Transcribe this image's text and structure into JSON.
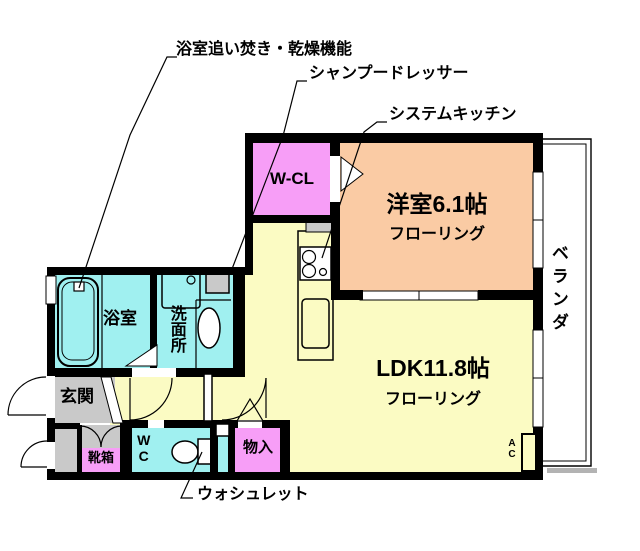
{
  "callouts": {
    "bath_reheat": "浴室追い焚き・乾燥機能",
    "shampoo_dresser": "シャンプードレッサー",
    "system_kitchen": "システムキッチン",
    "washlet": "ウォシュレット"
  },
  "rooms": {
    "walk_in_closet": "W-CL",
    "western_room": "洋室6.1帖",
    "western_room_floor": "フローリング",
    "ldk": "LDK11.8帖",
    "ldk_floor": "フローリング",
    "bathroom": "浴室",
    "washroom": "洗面所",
    "toilet": "WC",
    "storage": "物入",
    "shoe_box": "靴箱",
    "entrance": "玄関",
    "veranda": "ベランダ",
    "air_con": "AC"
  },
  "colors": {
    "wall": "#000000",
    "ldk_yellow": "#FBFBC3",
    "western_room_peach": "#FACBA4",
    "closet_pink": "#F79EF7",
    "wet_area_cyan": "#A0F0F0",
    "entrance_gray": "#C9C9C9",
    "background": "#FFFFFF"
  }
}
